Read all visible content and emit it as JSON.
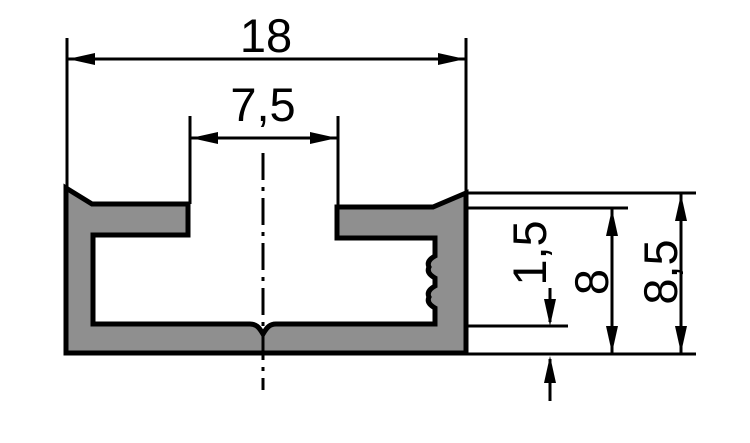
{
  "drawing": {
    "kind": "t-slot-profile-cross-section",
    "dimensions": {
      "overall_width": {
        "label": "18",
        "value": 18
      },
      "slot_width": {
        "label": "7,5",
        "value": 7.5
      },
      "base_thickness": {
        "label": "1,5",
        "value": 1.5
      },
      "side_height": {
        "label": "8",
        "value": 8
      },
      "overall_height": {
        "label": "8,5",
        "value": 8.5
      }
    },
    "colors": {
      "profile_fill": "#8f8f8f",
      "line_color": "#000000",
      "background": "#ffffff"
    }
  }
}
